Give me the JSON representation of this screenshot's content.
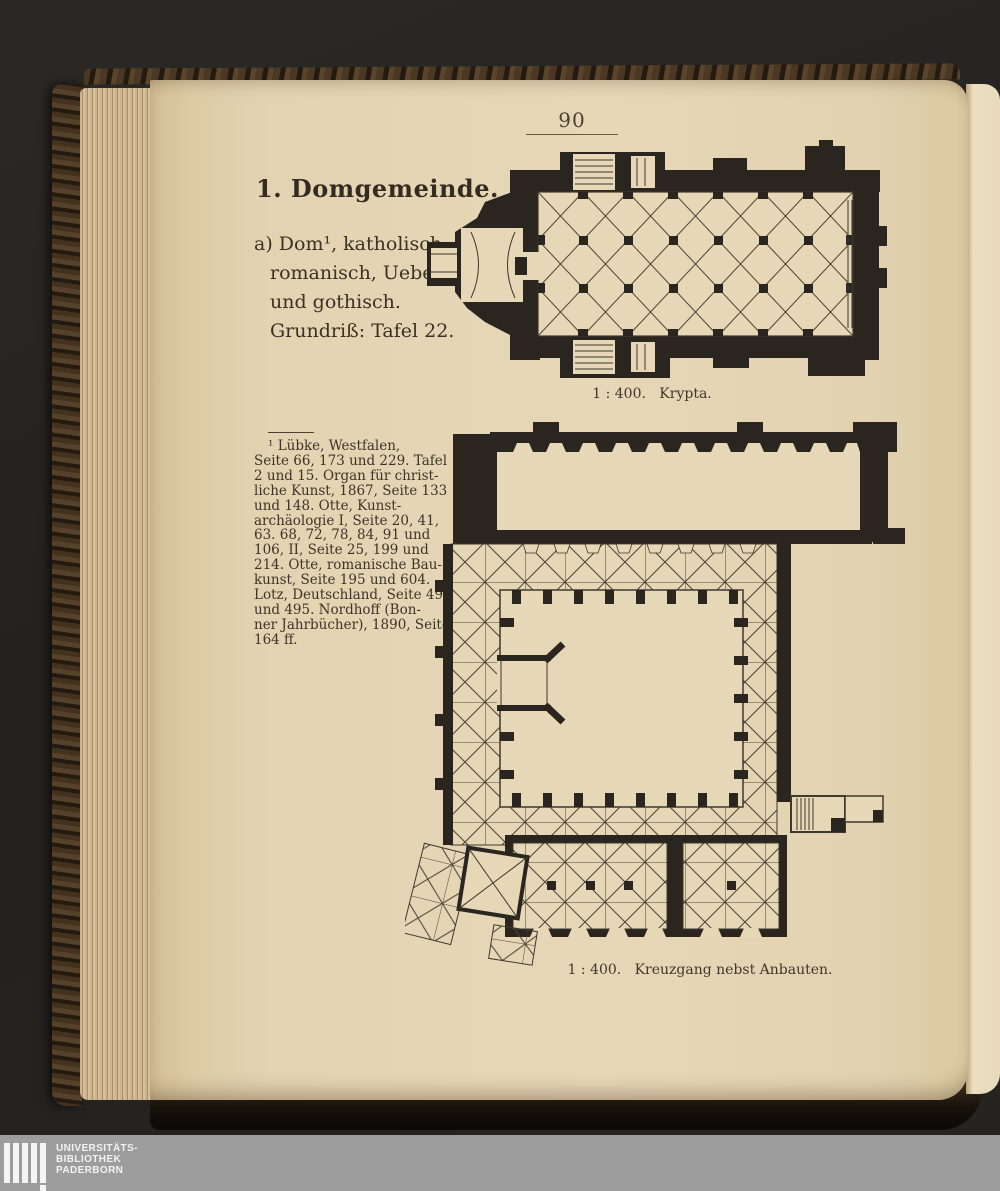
{
  "scan": {
    "page_number": "90",
    "heading": "1. Domgemeinde.",
    "intro": {
      "lines": [
        "a) Dom¹, katholisch;",
        "romanisch, Uebergang",
        "und gothisch.",
        "Grundriß: Tafel 22."
      ]
    },
    "captions": {
      "krypta": "1 : 400.   Krypta.",
      "kreuzgang": "1 : 400.   Kreuzgang nebst Anbauten."
    },
    "footnote": {
      "lines": [
        "¹ Lübke, Westfalen,",
        "Seite 66, 173 und 229. Tafel",
        "2 und 15. Organ für christ-",
        "liche Kunst, 1867, Seite 133",
        "und 148. Otte, Kunst-",
        "archäologie I, Seite 20, 41,",
        "63. 68, 72, 78, 84, 91 und",
        "106, II, Seite 25, 199 und",
        "214. Otte, romanische Bau-",
        "kunst, Seite 195 und 604.",
        "Lotz, Deutschland, Seite 494",
        "und 495. Nordhoff (Bon-",
        "ner Jahrbücher), 1890, Seite",
        "164 ff."
      ]
    }
  },
  "watermark": {
    "lines": [
      "UNIVERSITÄTS-",
      "BIBLIOTHEK",
      "PADERBORN"
    ]
  },
  "colors": {
    "page": "#e3d3b1",
    "ink": "#2b2520",
    "background": "#242220",
    "watermark_bar": "#9d9d9d"
  }
}
